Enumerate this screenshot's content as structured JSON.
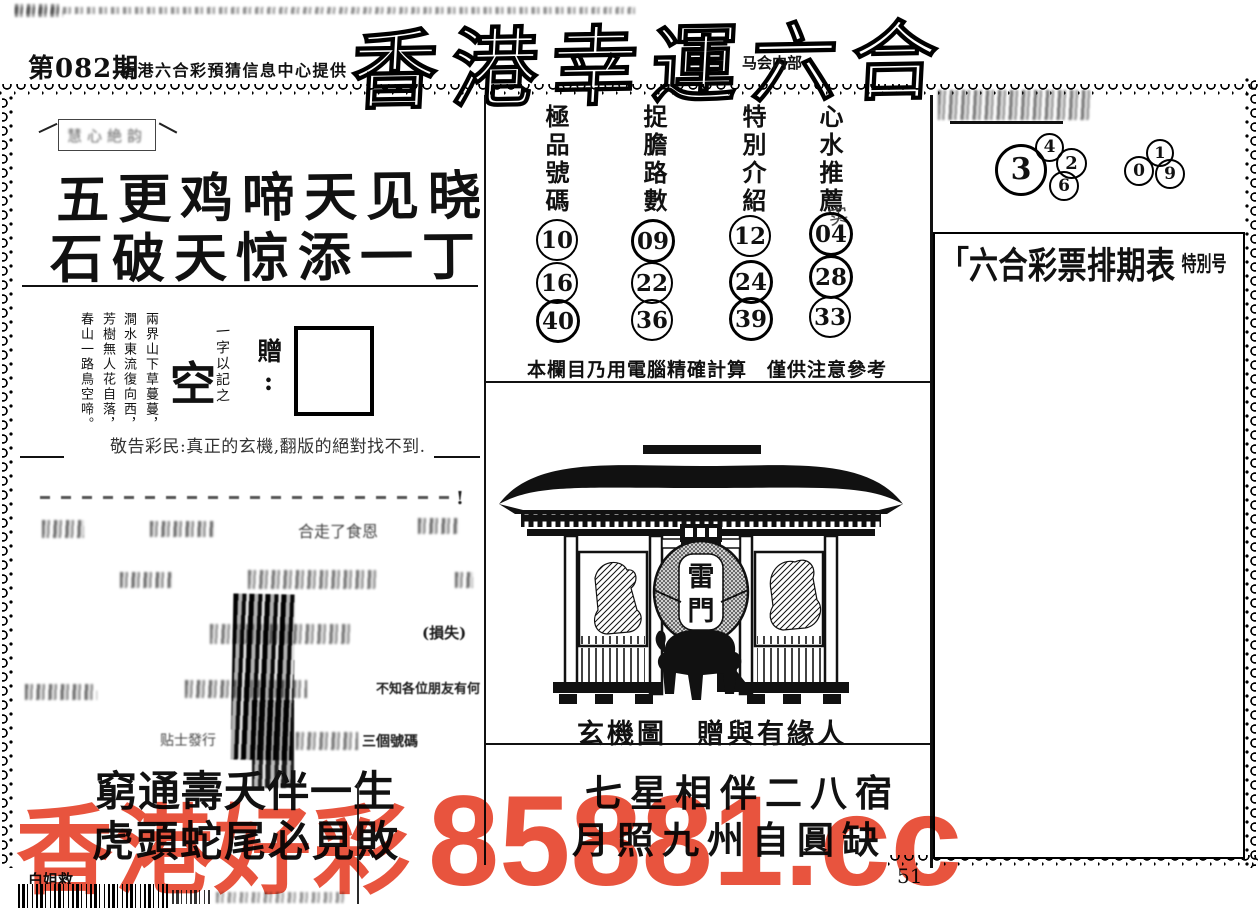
{
  "colors": {
    "watermark": "#e8543e",
    "ink": "#111111"
  },
  "page": {
    "issue": "第082期",
    "provider": "香港六合彩預猜信息中心提供",
    "title": "香港幸運六合",
    "title_sub": "马会内部",
    "page_number": "51"
  },
  "left": {
    "label_box_text": "慧心絶韵",
    "verse1": "五更鸡啼天见晓",
    "verse2": "石破天惊添一丁",
    "poem": [
      "兩界山下草蔓蔓，",
      "澗水東流復向西，",
      "芳樹無人花自落，",
      "春山一路鳥空啼。"
    ],
    "hint_note": "一字以記之",
    "hint_char": "空",
    "gift_label": "附贈:",
    "warning": "敬告彩民:真正的玄機,翻版的絕對找不到.",
    "fragments": {
      "excl": "!",
      "f1": "合走了食恩",
      "f2": "(損失)",
      "f3": "不知各位朋友有何",
      "f4": "贴士發行",
      "f5": "三個號碼"
    },
    "bottom_verse1": "窮通壽夭伴一生",
    "bottom_verse2": "虎頭蛇尾必見敗",
    "corner_text": "白姐救"
  },
  "center": {
    "columns": [
      {
        "header": "極品號碼",
        "numbers": [
          "10",
          "16",
          "40"
        ]
      },
      {
        "header": "捉膽路數",
        "numbers": [
          "09",
          "22",
          "36"
        ]
      },
      {
        "header": "特別介紹",
        "numbers": [
          "12",
          "24",
          "39"
        ]
      },
      {
        "header": "心水推薦",
        "numbers": [
          "04",
          "28",
          "33"
        ]
      }
    ],
    "stamp": "实",
    "note": "本欄目乃用電腦精確計算　僅供注意參考",
    "lantern": [
      "雷",
      "門"
    ],
    "caption": "玄機圖　贈與有緣人",
    "verse1": "七星相伴二八宿",
    "verse2": "月照九州自圓缺"
  },
  "right": {
    "big_number": "3",
    "cluster1": [
      "4",
      "2",
      "6"
    ],
    "cluster2": [
      "1",
      "0",
      "9"
    ],
    "box_bracket": "「",
    "box_title": "六合彩票排期表",
    "box_title_suffix": "特別号"
  },
  "watermark": {
    "cjk": "香港好彩",
    "code": "85881.cc"
  }
}
